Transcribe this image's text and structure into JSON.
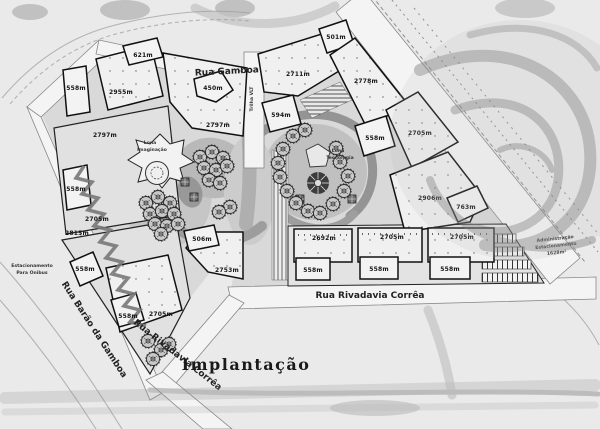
{
  "title": "Implantação",
  "streets": {
    "gamboa": "Rua Gamboa",
    "rivadavia": "Rua Rivadavia Corrêa",
    "rivadavia_diag": "Rua Rivadavia Corrêa",
    "barao": "Rua Barão da Gamboa",
    "vlt": "Trilha VLT"
  },
  "labels": {
    "bus_parking": [
      "Estacionamento",
      "Para Onibus"
    ],
    "admin_parking": [
      "Administração",
      "Estacionamento",
      "1628m²"
    ],
    "lona_left": [
      "Lona",
      "Imaginação"
    ],
    "lona_right": [
      "Lona",
      "Tecnologia"
    ]
  },
  "buildings": [
    {
      "name": "block-621",
      "label": "621m"
    },
    {
      "name": "block-2955",
      "label": "2955m"
    },
    {
      "name": "block-558-nw",
      "label": "558m"
    },
    {
      "name": "block-450",
      "label": "450m"
    },
    {
      "name": "block-2797-center",
      "label": "2797m"
    },
    {
      "name": "block-2797-west",
      "label": "2797m"
    },
    {
      "name": "block-594",
      "label": "594m"
    },
    {
      "name": "block-2711",
      "label": "2711m"
    },
    {
      "name": "block-501",
      "label": "501m"
    },
    {
      "name": "block-2778",
      "label": "2778m"
    },
    {
      "name": "block-558-east",
      "label": "558m"
    },
    {
      "name": "block-2705-east",
      "label": "2705m"
    },
    {
      "name": "block-2906",
      "label": "2906m"
    },
    {
      "name": "block-763",
      "label": "763m"
    },
    {
      "name": "block-558-west",
      "label": "558m"
    },
    {
      "name": "block-2705-west",
      "label": "2705m"
    },
    {
      "name": "block-2815",
      "label": "2815m"
    },
    {
      "name": "block-558-sw-upper",
      "label": "558m"
    },
    {
      "name": "block-506",
      "label": "506m"
    },
    {
      "name": "block-2753",
      "label": "2753m"
    },
    {
      "name": "block-558-sw-lower",
      "label": "558m"
    },
    {
      "name": "block-2705-sw",
      "label": "2705m"
    },
    {
      "name": "block-2692",
      "label": "2692m"
    },
    {
      "name": "block-2705-south-2",
      "label": "2705m"
    },
    {
      "name": "block-2705-south-3",
      "label": "2705m"
    },
    {
      "name": "block-558-south-1",
      "label": "558m"
    },
    {
      "name": "block-558-south-2",
      "label": "558m"
    },
    {
      "name": "block-558-south-3",
      "label": "558m"
    }
  ]
}
